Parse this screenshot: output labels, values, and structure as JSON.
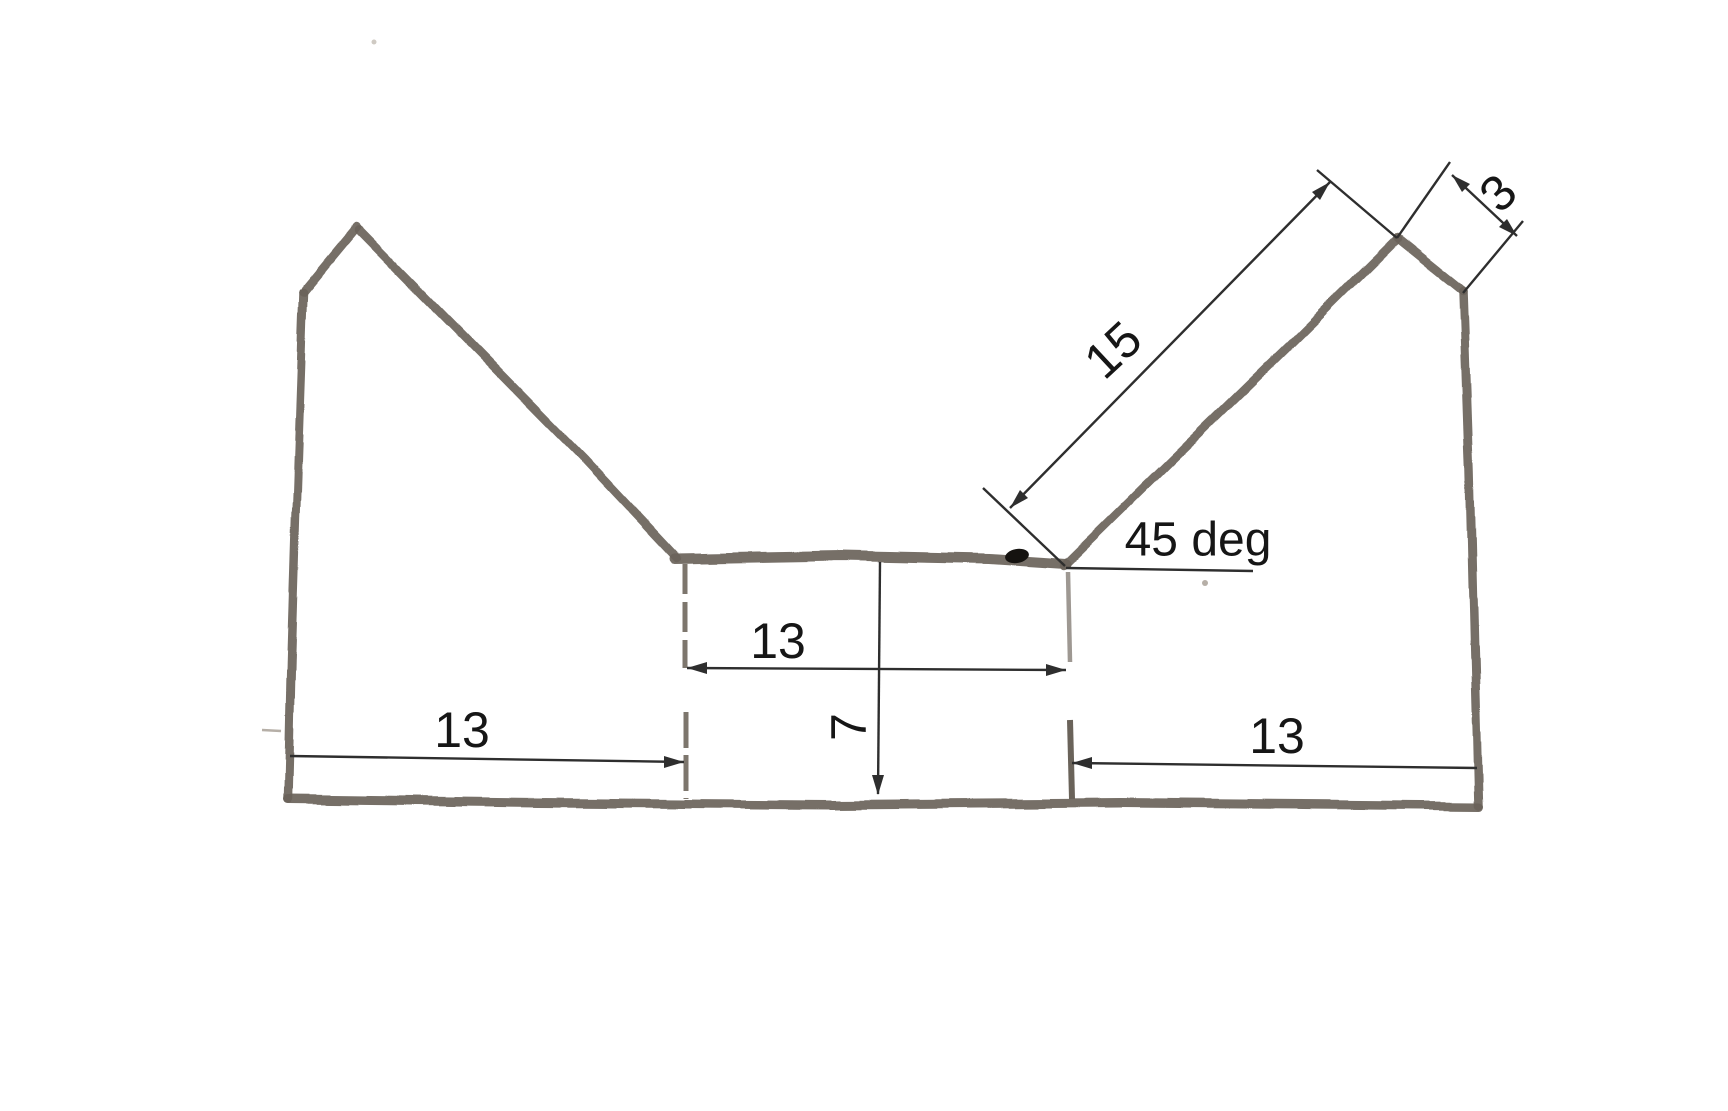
{
  "colors": {
    "paper": "#ffffff",
    "pencil": "#6a635a",
    "dimension_line": "#2e2e2e",
    "label_text": "#161616"
  },
  "sketch": {
    "kind": "hand-drawn dimensioned profile sketch",
    "labels": {
      "diagonal_length": "15",
      "top_cut_length": "3",
      "angle": "45 deg",
      "middle_width": "13",
      "bottom_left_width": "13",
      "bottom_right_width": "13",
      "center_depth": "7"
    }
  }
}
